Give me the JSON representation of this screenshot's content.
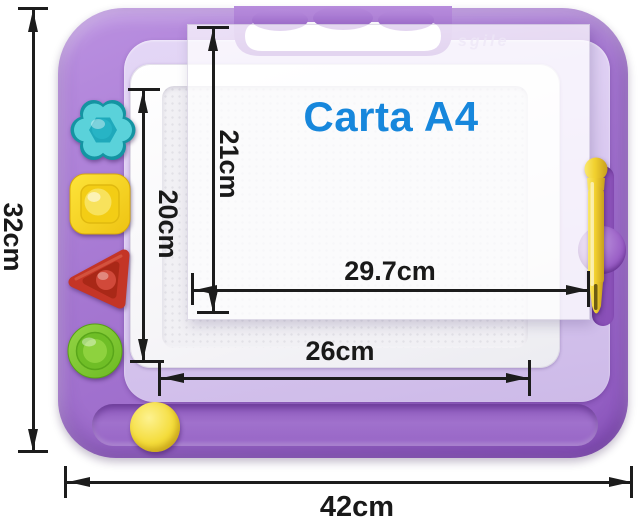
{
  "overlay": {
    "title": "Carta A4"
  },
  "brand_watermark": "sgile",
  "annotations": {
    "board_height": "32cm",
    "board_width": "42cm",
    "screen_height": "20cm",
    "screen_width": "26cm",
    "a4_sheet_height": "21cm",
    "a4_sheet_width": "29.7cm"
  },
  "colors": {
    "shell_purple": "#a273d0",
    "inner_frame_lavender": "#d9c8f0",
    "title_blue": "#1787dc",
    "annotation_ink": "#1c1c1c",
    "flower_stamp_teal": "#3fc3cf",
    "square_stamp_yellow": "#f7d71f",
    "triangle_stamp_red": "#c43526",
    "circle_stamp_green": "#7cc72f",
    "pen_yellow": "#f0cf2c",
    "eraser_knob_yellow": "#f2d727"
  }
}
